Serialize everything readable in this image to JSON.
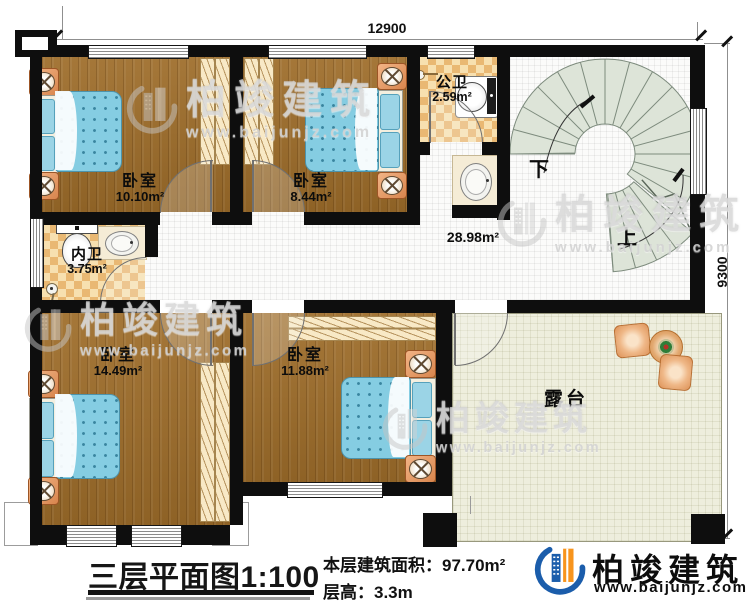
{
  "dimensions": {
    "top": "12900",
    "right": "9300"
  },
  "rooms": {
    "bedroom_tl": {
      "label": "卧室",
      "area": "10.10m²"
    },
    "bedroom_tm": {
      "label": "卧室",
      "area": "8.44m²"
    },
    "bedroom_bl": {
      "label": "卧室",
      "area": "14.49m²"
    },
    "bedroom_bm": {
      "label": "卧室",
      "area": "11.88m²"
    },
    "public_bath": {
      "label": "公卫",
      "area": "2.59m²"
    },
    "ensuite_bath": {
      "label": "内卫",
      "area": "3.75m²"
    },
    "hallway": {
      "area": "28.98m²"
    },
    "terrace": {
      "label": "露台"
    }
  },
  "stairs": {
    "down": "下",
    "up": "上"
  },
  "footer": {
    "plan_title": "三层平面图",
    "plan_scale": "1:100",
    "floor_area": "本层建筑面积：97.70m²",
    "floor_height": "层高：3.3m"
  },
  "brand": {
    "name": "柏竣建筑",
    "website": "www.baijunjz.com"
  },
  "watermark": {
    "name": "柏竣建筑",
    "website": "www.baijunjz.com"
  }
}
